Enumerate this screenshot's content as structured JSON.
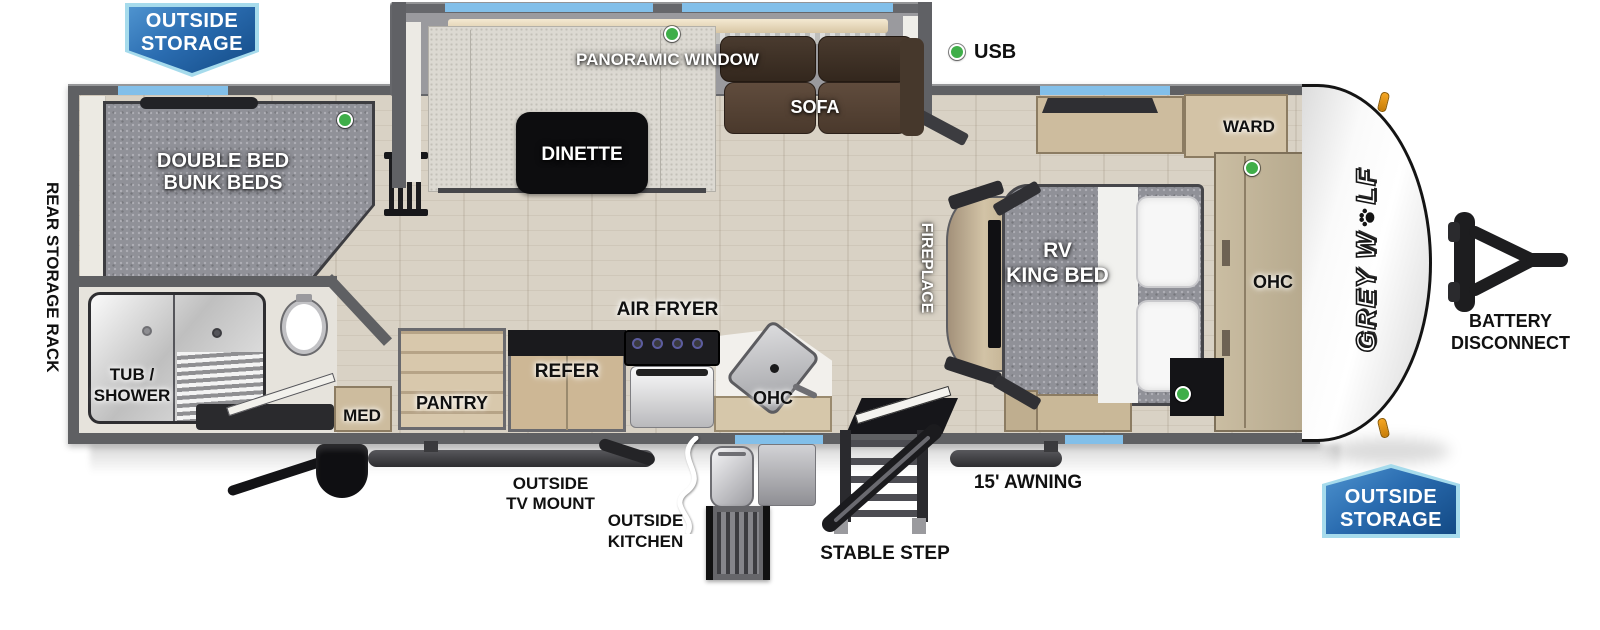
{
  "colors": {
    "accent_window_blue": "#82bfe9",
    "badge_border_blue": "#a6dbec",
    "badge_fill_blue": "#134a85",
    "usb_indicator_green": "#3fae49",
    "marker_light_amber": "#f5a623",
    "wall_gray": "#5f6063"
  },
  "legend": {
    "usb_label": "USB"
  },
  "badges": {
    "top_left": {
      "line1": "OUTSIDE",
      "line2": "STORAGE"
    },
    "bottom_right": {
      "line1": "OUTSIDE",
      "line2": "STORAGE"
    }
  },
  "exterior": {
    "rear_storage_rack": "REAR STORAGE RACK",
    "outside_tv_mount": {
      "line1": "OUTSIDE",
      "line2": "TV MOUNT"
    },
    "outside_kitchen": {
      "line1": "OUTSIDE",
      "line2": "KITCHEN"
    },
    "stable_step": "STABLE STEP",
    "awning": "15' AWNING",
    "battery_disconnect": {
      "line1": "BATTERY",
      "line2": "DISCONNECT"
    }
  },
  "brand": {
    "part1": "GREY W",
    "part2": "LF"
  },
  "rooms": {
    "bunk": {
      "line1": "DOUBLE BED",
      "line2": "BUNK BEDS"
    },
    "bath": {
      "line1": "TUB /",
      "line2": "SHOWER"
    },
    "med": "MED",
    "pantry": "PANTRY",
    "refer": "REFER",
    "air_fryer": "AIR FRYER",
    "ohc_kitchen": "OHC",
    "dinette": "DINETTE",
    "panoramic_window": "PANORAMIC WINDOW",
    "sofa": "SOFA",
    "fireplace": "FIREPLACE",
    "king_bed": {
      "line1": "RV",
      "line2": "KING BED"
    },
    "ward": "WARD",
    "ohc_bedroom": "OHC"
  }
}
